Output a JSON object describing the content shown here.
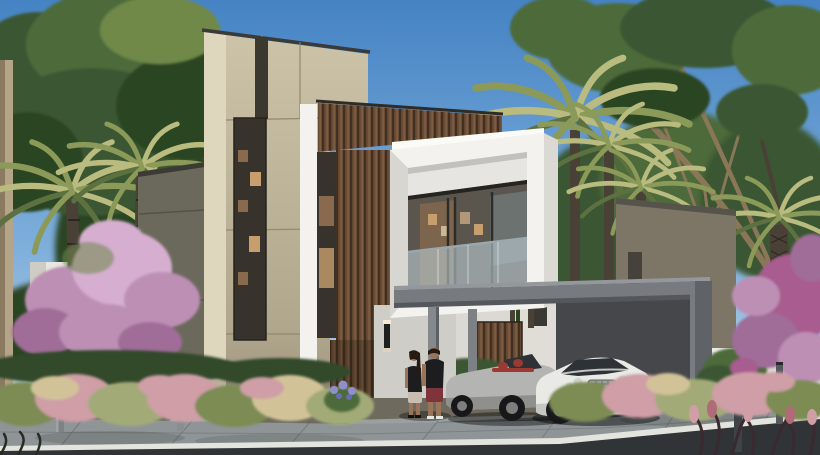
{
  "meta": {
    "type": "architectural-exterior-render",
    "width": 820,
    "height": 455,
    "time_of_day": "daytime-clear-sky"
  },
  "scene": {
    "subject": "modern-two-storey-villa",
    "elements": [
      "blue-sky",
      "large-green-tree-left",
      "date-palms",
      "background-tree-line",
      "beige-stone-tower",
      "grey-side-wing",
      "vertical-slot-windows-warm-interior",
      "wood-slat-cladding-band",
      "white-cantilever-window-box",
      "glass-balustrade",
      "entrance-wood-door",
      "wall-sconce",
      "dark-grey-carport-canopy",
      "silver-convertible-car",
      "white-coupe-car",
      "couple-walking",
      "neighbor-house-left-white",
      "neighbor-house-right-grey",
      "white-boundary-wall",
      "bougainvillea-pink",
      "pink-flowering-tree",
      "ornamental-grasses",
      "purple-flowers",
      "bollard-lights",
      "driveway",
      "sidewalk",
      "white-curb",
      "asphalt-road"
    ],
    "vehicles": [
      {
        "name": "silver-convertible",
        "body_color": "#b4b4b2",
        "interior_color": "#9a3a30"
      },
      {
        "name": "white-coupe",
        "body_color": "#e9e9e6",
        "glass_color": "#2e3236"
      }
    ],
    "people": [
      {
        "name": "woman",
        "hair": "#241b14",
        "top": "#1d1d20",
        "shorts": "#c9bdb2"
      },
      {
        "name": "man",
        "hair": "#241b14",
        "shirt": "#1d1d20",
        "shorts": "#7e343a"
      }
    ]
  },
  "palette": {
    "sky-top": "#4583c4",
    "sky-mid": "#7fafdb",
    "sky-horizon": "#b3cfe6",
    "foliage-deep": "#2c4424",
    "foliage-dark": "#3a5730",
    "foliage-mid": "#4d6b3a",
    "foliage-light": "#70894a",
    "palm-lit": "#b9bb7f",
    "palm-olive": "#8b9a58",
    "palm-shadow": "#5d7140",
    "branch": "#8a7757",
    "trunk-dark": "#4a4136",
    "trunk-light": "#b4a488",
    "stone-light": "#ded6bd",
    "stone-mid": "#ccc3a8",
    "stone-shadow": "#b0a78d",
    "stone-deep": "#9a9179",
    "wing-gray": "#6b695c",
    "wing-line": "#54524a",
    "white-wall": "#f3f2ee",
    "white-shade": "#dbd9d4",
    "white-dim": "#cfcdc7",
    "wood-mid": "#6a4c36",
    "wood-dark": "#41301f",
    "wood-light": "#8a6848",
    "glass-dark": "#37332c",
    "interior-warm": "#8a6a4c",
    "interior-glow": "#c79e6e",
    "glass-blue": "#8fa5b0",
    "balustrade": "#bccdd3",
    "canopy-top": "#94989c",
    "canopy-face": "#777b7f",
    "canopy-shade": "#54585c",
    "post-gray": "#85898c",
    "interior-wall": "#46474b",
    "car-silver": "#b4b4b2",
    "car-silver-shade": "#8f8f8d",
    "car-white": "#e9e9e6",
    "car-white-shade": "#c6c6c2",
    "car-glass": "#2e3236",
    "car-red": "#9a3a30",
    "wheel-dark": "#18181a",
    "rim-gray": "#7e7e7c",
    "chrome": "#cfd4cc",
    "skin": "#9a7458",
    "hair-dark": "#241b14",
    "shirt-dark": "#1d1d20",
    "shorts-red": "#7e343a",
    "shorts-light": "#c9bdb2",
    "pink-light": "#d6aed0",
    "pink-mid": "#bd8fb5",
    "pink-deep": "#a06c98",
    "bougainvillea": "#a85c90",
    "grass-pink": "#cf9ea6",
    "grass-wheat": "#d2c298",
    "grass-green": "#7c8c52",
    "grass-sage": "#a2aa78",
    "hedge": "#31492a",
    "purple-flower": "#8e90cc",
    "soil": "#6e6a5e",
    "drive-gray": "#9b9fa0",
    "walk-gray": "#8f9496",
    "walk-light": "#a6abac",
    "curb-white": "#e4e4de",
    "road-dark": "#313436"
  }
}
